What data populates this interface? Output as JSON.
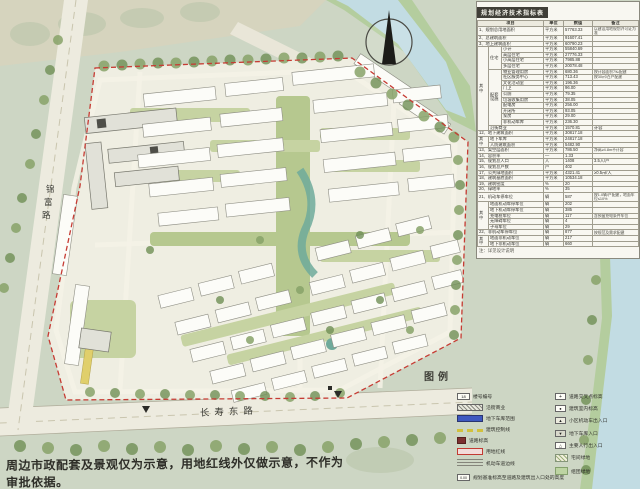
{
  "map": {
    "legend_title": "图例",
    "roads": {
      "left": "锦富路",
      "bottom": "长寿东路"
    },
    "disclaimer": "周边市政配套及景观仅为示意，用地红线外仅做示意，不作为审批依据。",
    "compass": "north-arrow"
  },
  "table": {
    "title": "规划经济技术指标表",
    "note": "注：详见设计说明",
    "rows": [
      [
        {
          "t": "项目",
          "cs": 3,
          "h": 1
        },
        {
          "t": "单位",
          "h": 1
        },
        {
          "t": "数值",
          "h": 1
        },
        {
          "t": "备注",
          "h": 1
        }
      ],
      [
        {
          "t": "1、规划总用地面积",
          "cs": 3
        },
        {
          "t": "平方米"
        },
        {
          "t": "57763.33"
        },
        {
          "t": "以建设用地规划许可证为准",
          "k": 1
        }
      ],
      [
        {
          "t": "2、总建筑面积",
          "cs": 3
        },
        {
          "t": "平方米"
        },
        {
          "t": "91607.41"
        },
        {
          "t": ""
        }
      ],
      [
        {
          "t": "3、地上建筑面积",
          "cs": 3
        },
        {
          "t": "平方米"
        },
        {
          "t": "60790.23"
        },
        {
          "t": ""
        }
      ],
      [
        {
          "t": "其中",
          "rs": 15
        },
        {
          "t": "住宅",
          "rs": 4
        },
        {
          "t": "小计"
        },
        {
          "t": "平方米"
        },
        {
          "t": "55840.69"
        },
        {
          "t": ""
        }
      ],
      [
        {
          "t": "高层住宅"
        },
        {
          "t": "平方米"
        },
        {
          "t": "27776.33"
        },
        {
          "t": ""
        }
      ],
      [
        {
          "t": "小高层住宅"
        },
        {
          "t": "平方米"
        },
        {
          "t": "7985.88"
        },
        {
          "t": ""
        }
      ],
      [
        {
          "t": "多层住宅"
        },
        {
          "t": "平方米"
        },
        {
          "t": "20078.48"
        },
        {
          "t": ""
        }
      ],
      [
        {
          "t": "配套设施",
          "rs": 10
        },
        {
          "t": "物业管理用房"
        },
        {
          "t": "平方米"
        },
        {
          "t": "680.36"
        },
        {
          "t": "按计容面积7‰配建",
          "k": 1
        }
      ],
      [
        {
          "t": "社区服务中心"
        },
        {
          "t": "平方米"
        },
        {
          "t": "713.43"
        },
        {
          "t": "按30㎡/百户配建",
          "k": 1
        }
      ],
      [
        {
          "t": "文化活动室"
        },
        {
          "t": "平方米"
        },
        {
          "t": "196.36"
        },
        {
          "t": ""
        }
      ],
      [
        {
          "t": "门卫"
        },
        {
          "t": "平方米"
        },
        {
          "t": "96.00"
        },
        {
          "t": ""
        }
      ],
      [
        {
          "t": "公厕"
        },
        {
          "t": "平方米"
        },
        {
          "t": "79.35"
        },
        {
          "t": ""
        }
      ],
      [
        {
          "t": "垃圾收集用房"
        },
        {
          "t": "平方米"
        },
        {
          "t": "38.05"
        },
        {
          "t": ""
        }
      ],
      [
        {
          "t": "配电房"
        },
        {
          "t": "平方米"
        },
        {
          "t": "256.00"
        },
        {
          "t": ""
        }
      ],
      [
        {
          "t": "开闭所"
        },
        {
          "t": "平方米"
        },
        {
          "t": "93.05"
        },
        {
          "t": ""
        }
      ],
      [
        {
          "t": "泵房"
        },
        {
          "t": "平方米"
        },
        {
          "t": "29.00"
        },
        {
          "t": ""
        }
      ],
      [
        {
          "t": "非机动车库"
        },
        {
          "t": "平方米"
        },
        {
          "t": "236.30"
        },
        {
          "t": ""
        }
      ],
      [
        {
          "t": "沿街商业",
          "cs": 2
        },
        {
          "t": "平方米"
        },
        {
          "t": "1570.81"
        },
        {
          "t": "计容"
        }
      ],
      [
        {
          "t": "12、地下建筑面积",
          "cs": 3
        },
        {
          "t": "平方米"
        },
        {
          "t": "30817.18"
        },
        {
          "t": ""
        }
      ],
      [
        {
          "t": "其中",
          "rs": 2
        },
        {
          "t": "地下车库",
          "cs": 2
        },
        {
          "t": "平方米"
        },
        {
          "t": "24817.18"
        },
        {
          "t": ""
        }
      ],
      [
        {
          "t": "人防建筑面积",
          "cs": 2
        },
        {
          "t": "平方米"
        },
        {
          "t": "5482.90"
        },
        {
          "t": ""
        }
      ],
      [
        {
          "t": "13、架空层面积",
          "cs": 3
        },
        {
          "t": "平方米"
        },
        {
          "t": "786.50"
        },
        {
          "t": "净高≥4.8m不计容",
          "k": 1
        }
      ],
      [
        {
          "t": "14、容积率",
          "cs": 3
        },
        {
          "t": "—"
        },
        {
          "t": "1.33"
        },
        {
          "t": ""
        }
      ],
      [
        {
          "t": "15、规划总人口",
          "cs": 3
        },
        {
          "t": "人"
        },
        {
          "t": "1408"
        },
        {
          "t": "3.5人/户"
        }
      ],
      [
        {
          "t": "16、规划总户数",
          "cs": 3
        },
        {
          "t": "户"
        },
        {
          "t": "402"
        },
        {
          "t": ""
        }
      ],
      [
        {
          "t": "17、公共绿地面积",
          "cs": 3
        },
        {
          "t": "平方米"
        },
        {
          "t": "4321.41"
        },
        {
          "t": "≥0.5㎡/人"
        }
      ],
      [
        {
          "t": "18、建筑基底面积",
          "cs": 3
        },
        {
          "t": "平方米"
        },
        {
          "t": "10534.18"
        },
        {
          "t": ""
        }
      ],
      [
        {
          "t": "19、建筑密度",
          "cs": 3
        },
        {
          "t": "%"
        },
        {
          "t": "20"
        },
        {
          "t": ""
        }
      ],
      [
        {
          "t": "20、绿地率",
          "cs": 3
        },
        {
          "t": "%"
        },
        {
          "t": "35"
        },
        {
          "t": ""
        }
      ],
      [
        {
          "t": "21、机动车停车位",
          "cs": 3
        },
        {
          "t": "辆"
        },
        {
          "t": "587"
        },
        {
          "t": "按1.0辆/户配建，地面车位≤10%",
          "k": 1
        }
      ],
      [
        {
          "t": "其中",
          "rs": 5
        },
        {
          "t": "地面机动车停车位",
          "cs": 2
        },
        {
          "t": "辆"
        },
        {
          "t": "202"
        },
        {
          "t": ""
        }
      ],
      [
        {
          "t": "地下机动车停车位",
          "cs": 2
        },
        {
          "t": "辆"
        },
        {
          "t": "385"
        },
        {
          "t": ""
        }
      ],
      [
        {
          "t": "充电桩车位",
          "cs": 2
        },
        {
          "t": "辆"
        },
        {
          "t": "117"
        },
        {
          "t": "含预留充电条件车位",
          "k": 1
        }
      ],
      [
        {
          "t": "无障碍车位",
          "cs": 2
        },
        {
          "t": "辆"
        },
        {
          "t": "4"
        },
        {
          "t": ""
        }
      ],
      [
        {
          "t": "子母车位",
          "cs": 2
        },
        {
          "t": "辆"
        },
        {
          "t": "29"
        },
        {
          "t": ""
        }
      ],
      [
        {
          "t": "22、非机动车停车位",
          "cs": 3
        },
        {
          "t": "辆"
        },
        {
          "t": "877"
        },
        {
          "t": "按规范及需求配建",
          "k": 1
        }
      ],
      [
        {
          "t": "其中",
          "rs": 2
        },
        {
          "t": "地面非机动车位",
          "cs": 2
        },
        {
          "t": "辆"
        },
        {
          "t": "217"
        },
        {
          "t": ""
        }
      ],
      [
        {
          "t": "地下非机动车位",
          "cs": 2
        },
        {
          "t": "辆"
        },
        {
          "t": "660"
        },
        {
          "t": ""
        }
      ]
    ]
  },
  "legend": {
    "left": [
      {
        "sym": "num-box",
        "g": "18",
        "label": "楼号编号"
      },
      {
        "sym": "commercial-bar",
        "label": "沿街商业"
      },
      {
        "sym": "garage-bar",
        "label": "地下车库范围"
      },
      {
        "sym": "control-line",
        "label": "建筑控制线"
      },
      {
        "sym": "road-elev",
        "label": "道路标高"
      },
      {
        "sym": "red-line",
        "label": "用地红线"
      },
      {
        "sym": "lane-line",
        "label": "机动车道边线"
      }
    ],
    "right": [
      {
        "sym": "cross-elev",
        "g": "+",
        "label": "道路交叉点标高"
      },
      {
        "sym": "indoor-elev",
        "g": "●",
        "label": "建筑室内标高"
      },
      {
        "sym": "car-entry",
        "g": "▲",
        "label": "小区机动车出入口"
      },
      {
        "sym": "garage-entry",
        "g": "▼",
        "label": "地下车库入口"
      },
      {
        "sym": "ped-entry",
        "g": "△",
        "label": "主要人行出入口"
      },
      {
        "sym": "house-green",
        "label": "宅间绿地"
      },
      {
        "sym": "cluster-green",
        "label": "组团绿地"
      }
    ],
    "note": {
      "sym": "datum-box",
      "g": "0.00",
      "label": "规划基准标高至道路及建筑出入口处的高度"
    }
  }
}
